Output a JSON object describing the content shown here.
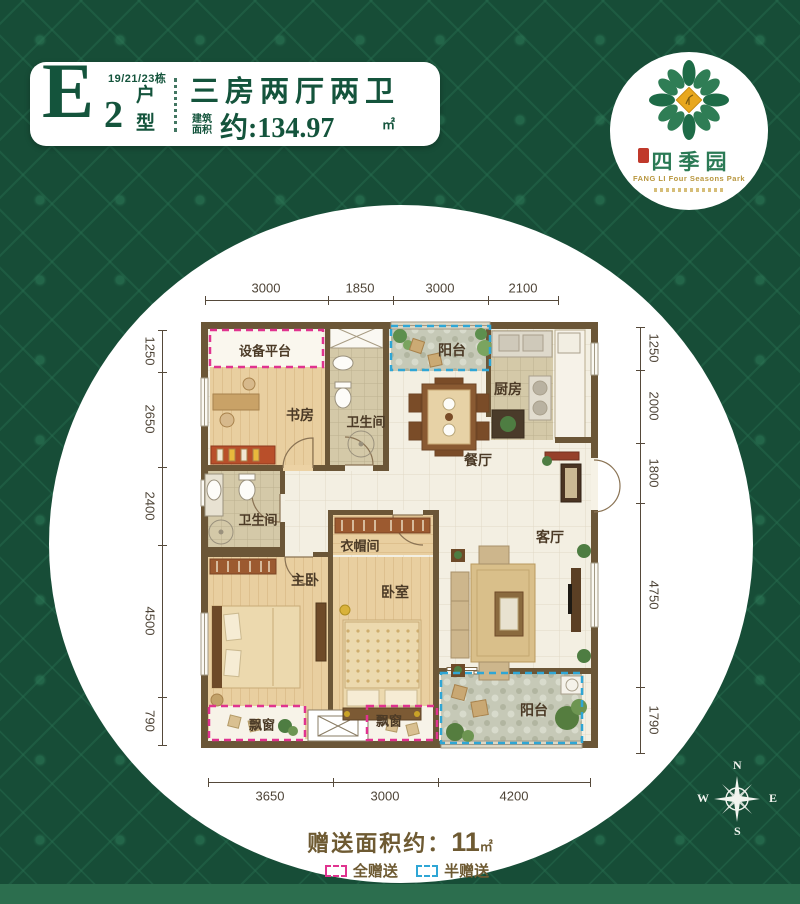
{
  "header": {
    "unit_letter": "E",
    "unit_number": "2",
    "buildings": "19/21/23栋",
    "unit_char_top": "户",
    "unit_char_bottom": "型",
    "title": "三房两厅两卫",
    "area_prefix_top": "建筑",
    "area_prefix_bottom": "面积",
    "area_value": "约:134.97",
    "area_unit": "㎡"
  },
  "logo": {
    "name": "四季园",
    "english": "FANG LI Four Seasons Park"
  },
  "rooms": {
    "equipment_platform": "设备平台",
    "study": "书房",
    "bathroom1": "卫生间",
    "balcony_top": "阳台",
    "kitchen": "厨房",
    "dining": "餐厅",
    "bathroom2": "卫生间",
    "cloakroom": "衣帽间",
    "master_bedroom": "主卧",
    "bedroom": "卧室",
    "living": "客厅",
    "bay_window_left": "飘窗",
    "bay_window_right": "飘窗",
    "balcony_bottom": "阳台"
  },
  "dimensions": {
    "top": [
      "3000",
      "1850",
      "3000",
      "2100"
    ],
    "bottom": [
      "3650",
      "3000",
      "4200"
    ],
    "left": [
      "1250",
      "2650",
      "2400",
      "4500",
      "790"
    ],
    "right": [
      "1250",
      "2000",
      "1800",
      "4750",
      "1790"
    ]
  },
  "footer": {
    "gift_area_label": "赠送面积约：",
    "gift_area_value": "11",
    "gift_area_unit": "㎡",
    "legend_full": "全赠送",
    "legend_half": "半赠送"
  },
  "compass": {
    "n": "N",
    "e": "E",
    "s": "S",
    "w": "W"
  },
  "colors": {
    "background_green": "#174d37",
    "brand_green": "#14543c",
    "wall_brown": "#6b5637",
    "full_gift_magenta": "#e0338f",
    "half_gift_cyan": "#2fa6d5",
    "footer_brown": "#6e5a32",
    "logo_gold": "#b8963e"
  }
}
